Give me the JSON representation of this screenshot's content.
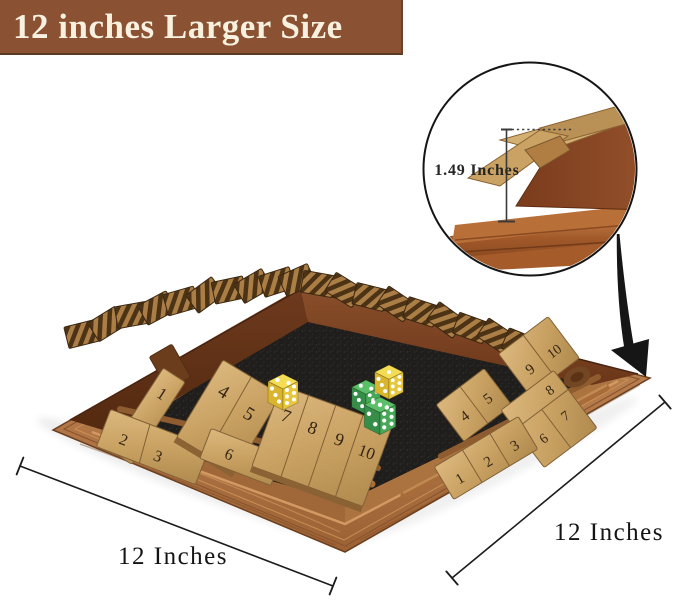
{
  "banner": {
    "label": "12 inches Larger Size",
    "bg_color": "#8a5233",
    "text_color": "#f8f1df"
  },
  "size_callout": {
    "measurement_label": "1.49 Inches"
  },
  "dimension_annotations": {
    "bottom_width_label": "12 Inches",
    "right_depth_label": "12 Inches",
    "line_color": "#1c1c1c"
  },
  "board": {
    "front_numbers": [
      "1",
      "2",
      "3",
      "4",
      "5",
      "6",
      "7",
      "8",
      "9",
      "10"
    ],
    "right_numbers": [
      "1",
      "2",
      "3",
      "4",
      "5",
      "6",
      "7",
      "8",
      "9",
      "10"
    ],
    "back_left_row_state": "tiles flipped shut",
    "back_right_row_state": "tiles flipped shut",
    "felt_color": "#1f1e1c",
    "rim_wood_color": "#b5794a",
    "tile_wood_color": "#c9a263",
    "wall_wood_color": "#6b3a1e"
  },
  "dice": [
    {
      "position": "left",
      "color_name": "yellow",
      "hex": "#eccf45",
      "top_face": 2,
      "left_face": 3,
      "right_face": 6
    },
    {
      "position": "middle",
      "color_name": "green",
      "hex": "#4fae5b",
      "top_face": 2,
      "left_face": 3,
      "right_face": 5
    },
    {
      "position": "right",
      "color_name": "yellow",
      "hex": "#eccf45",
      "top_face": 1,
      "left_face": 3,
      "right_face": 6
    },
    {
      "position": "front",
      "color_name": "green",
      "hex": "#4fae5b",
      "top_face": 3,
      "left_face": 2,
      "right_face": 6
    }
  ]
}
